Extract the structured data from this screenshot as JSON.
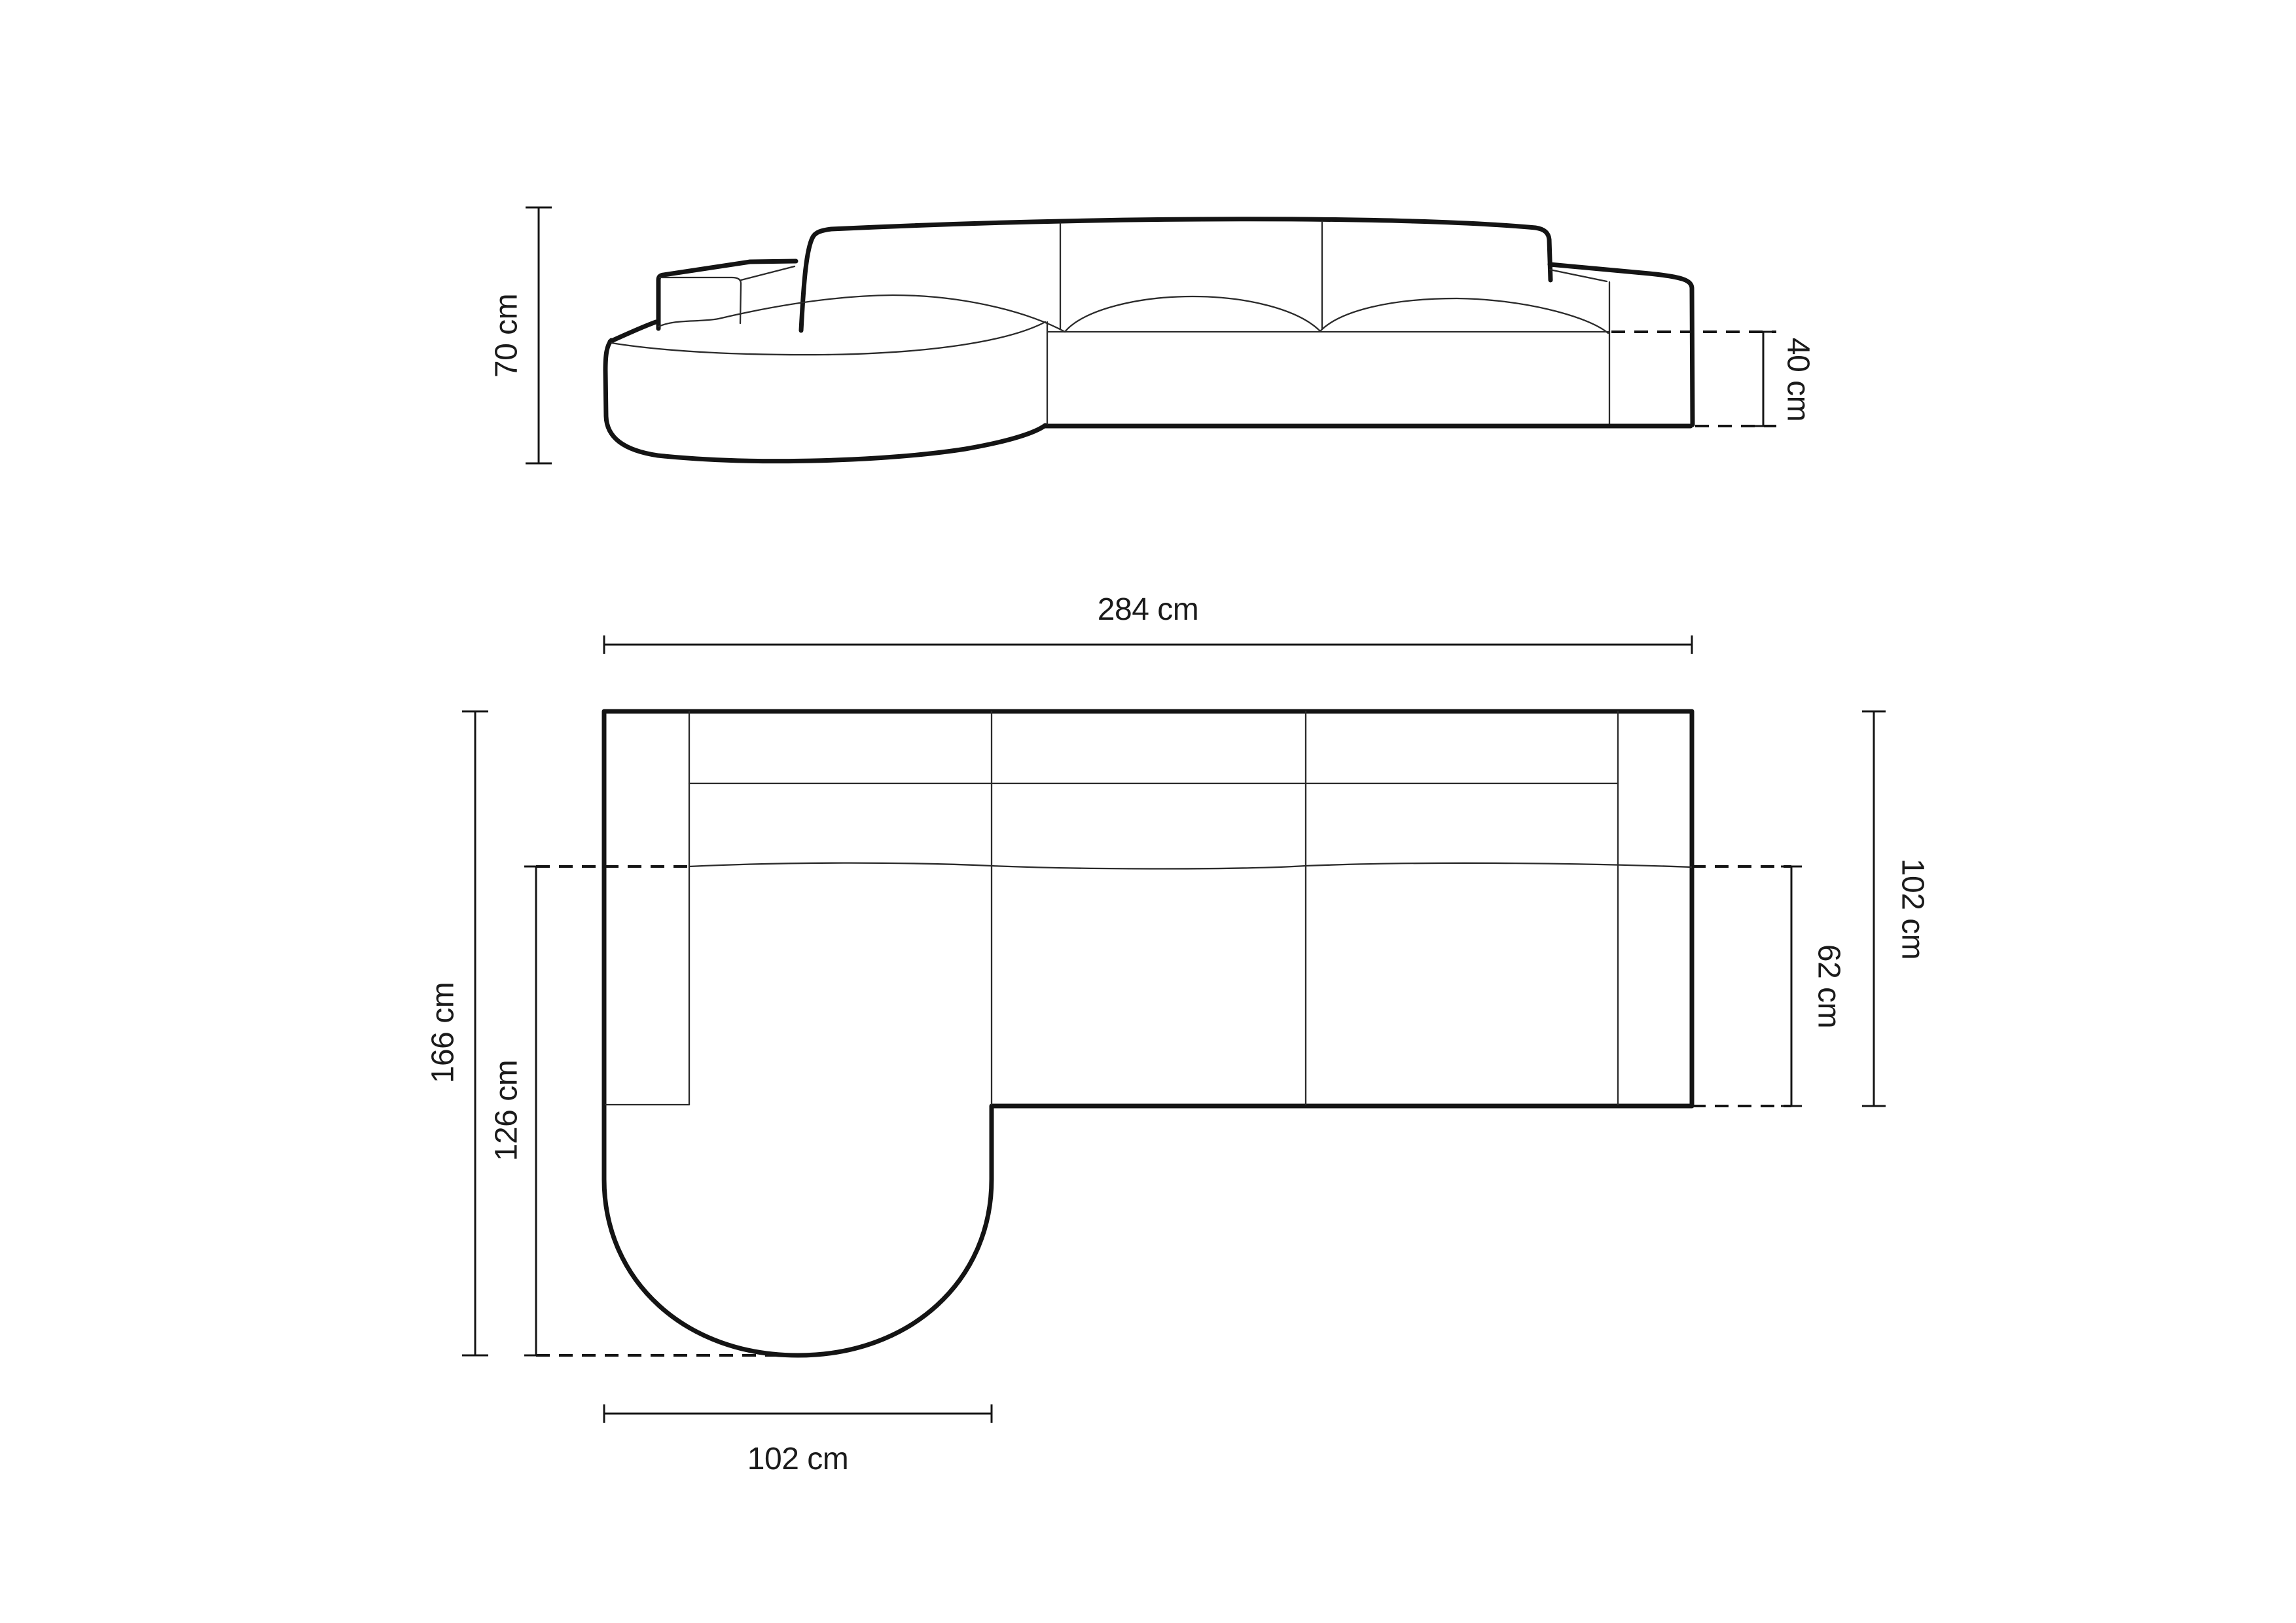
{
  "diagram": {
    "colors": {
      "background": "#ffffff",
      "line": "#141414",
      "text": "#1a1a1a"
    },
    "dimensions": {
      "elevation": {
        "total_height": {
          "value": 70,
          "unit": "cm",
          "label": "70 cm"
        },
        "seat_height": {
          "value": 40,
          "unit": "cm",
          "label": "40 cm"
        }
      },
      "plan": {
        "total_width": {
          "value": 284,
          "unit": "cm",
          "label": "284 cm"
        },
        "total_depth": {
          "value": 102,
          "unit": "cm",
          "label": "102 cm"
        },
        "seat_depth": {
          "value": 62,
          "unit": "cm",
          "label": "62 cm"
        },
        "chaise_total_depth": {
          "value": 166,
          "unit": "cm",
          "label": "166 cm"
        },
        "chaise_front_depth": {
          "value": 126,
          "unit": "cm",
          "label": "126 cm"
        },
        "chaise_width": {
          "value": 102,
          "unit": "cm",
          "label": "102 cm"
        }
      }
    }
  }
}
